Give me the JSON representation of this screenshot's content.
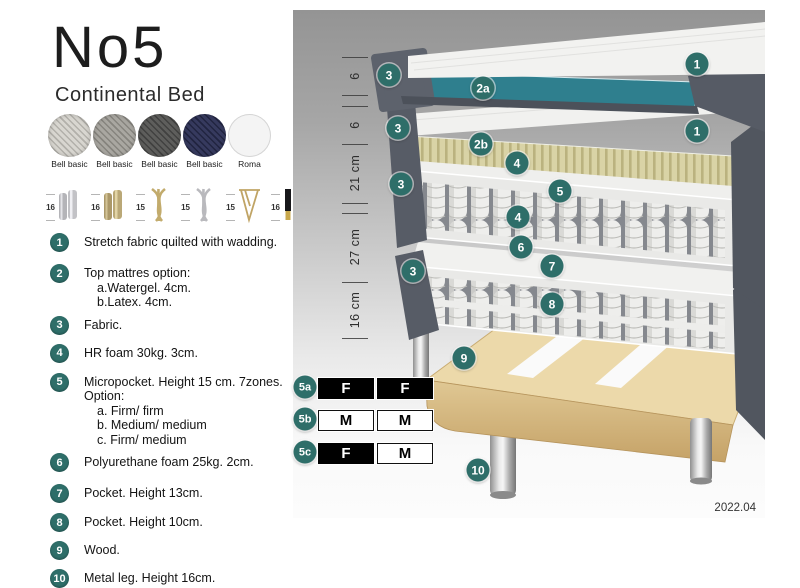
{
  "header": {
    "title": "No5",
    "subtitle": "Continental Bed"
  },
  "fabrics": [
    {
      "line1": "Bell basic",
      "line2": "MCD36",
      "color": "#d8d6d0",
      "weave": "#b2b0aa"
    },
    {
      "line1": "Bell basic",
      "line2": "MCD32",
      "color": "#a9a7a1",
      "weave": "#86847e"
    },
    {
      "line1": "Bell basic",
      "line2": "MCD43",
      "color": "#5e5e5c",
      "weave": "#414140"
    },
    {
      "line1": "Bell basic",
      "line2": "MCD74",
      "color": "#363a5e",
      "weave": "#212440"
    },
    {
      "line1": "Roma",
      "line2": "stretch fabric",
      "color": "#f4f4f4",
      "weave": "#e2e2e2"
    }
  ],
  "legs": [
    {
      "size": "16",
      "type": "cyl-silver"
    },
    {
      "size": "16",
      "type": "cyl-gold"
    },
    {
      "size": "15",
      "type": "twist-gold"
    },
    {
      "size": "15",
      "type": "twist-silver"
    },
    {
      "size": "15",
      "type": "hairpin"
    },
    {
      "size": "16",
      "type": "black-gold"
    }
  ],
  "features": [
    {
      "num": "1",
      "text": "Stretch fabric quilted with wadding.",
      "sub": []
    },
    {
      "num": "2",
      "text": "Top mattres option:",
      "sub": [
        "a.Watergel. 4cm.",
        "b.Latex. 4cm."
      ]
    },
    {
      "num": "3",
      "text": "Fabric.",
      "sub": []
    },
    {
      "num": "4",
      "text": "HR foam 30kg. 3cm.",
      "sub": []
    },
    {
      "num": "5",
      "text": "Micropocket. Height 15 cm. 7zones. Option:",
      "sub": [
        "a. Firm/ firm",
        "b. Medium/ medium",
        "c. Firm/ medium"
      ]
    },
    {
      "num": "6",
      "text": "Polyurethane foam 25kg. 2cm.",
      "sub": []
    },
    {
      "num": "7",
      "text": "Pocket. Height 13cm.",
      "sub": []
    },
    {
      "num": "8",
      "text": "Pocket. Height 10cm.",
      "sub": []
    },
    {
      "num": "9",
      "text": "Wood.",
      "sub": []
    },
    {
      "num": "10",
      "text": "Metal leg. Height 16cm.",
      "sub": []
    }
  ],
  "diagram": {
    "ruler": {
      "ticks": [
        47,
        85,
        96,
        134,
        193,
        203,
        272,
        328
      ],
      "labels": [
        {
          "text": "6",
          "y": 66
        },
        {
          "text": "6",
          "y": 115
        },
        {
          "text": "21 cm",
          "y": 163
        },
        {
          "text": "27 cm",
          "y": 237
        },
        {
          "text": "16 cm",
          "y": 300
        }
      ]
    },
    "badges": [
      {
        "label": "1",
        "x": 404,
        "y": 54
      },
      {
        "label": "3",
        "x": 96,
        "y": 65
      },
      {
        "label": "2a",
        "x": 190,
        "y": 78
      },
      {
        "label": "1",
        "x": 404,
        "y": 121
      },
      {
        "label": "3",
        "x": 105,
        "y": 118
      },
      {
        "label": "2b",
        "x": 188,
        "y": 134
      },
      {
        "label": "4",
        "x": 224,
        "y": 153
      },
      {
        "label": "3",
        "x": 108,
        "y": 174
      },
      {
        "label": "5",
        "x": 267,
        "y": 181
      },
      {
        "label": "4",
        "x": 225,
        "y": 207
      },
      {
        "label": "6",
        "x": 228,
        "y": 237
      },
      {
        "label": "3",
        "x": 120,
        "y": 261
      },
      {
        "label": "7",
        "x": 259,
        "y": 256
      },
      {
        "label": "8",
        "x": 259,
        "y": 294
      },
      {
        "label": "9",
        "x": 171,
        "y": 348
      },
      {
        "label": "10",
        "x": 185,
        "y": 460
      }
    ],
    "firmness": [
      {
        "badge": "5a",
        "y": 368,
        "cells": [
          {
            "t": "F",
            "dark": true
          },
          {
            "t": "F",
            "dark": true
          }
        ]
      },
      {
        "badge": "5b",
        "y": 400,
        "cells": [
          {
            "t": "M",
            "dark": false
          },
          {
            "t": "M",
            "dark": false
          }
        ]
      },
      {
        "badge": "5c",
        "y": 433,
        "cells": [
          {
            "t": "F",
            "dark": true
          },
          {
            "t": "M",
            "dark": false
          }
        ]
      }
    ],
    "version": "2022.04"
  },
  "colors": {
    "badge": "#2e6e69",
    "teal_core": "#2f7f8e",
    "shell_gray": "#575c66",
    "latex_tan": "#d9d3a6",
    "wood": "#e7d5a8"
  }
}
